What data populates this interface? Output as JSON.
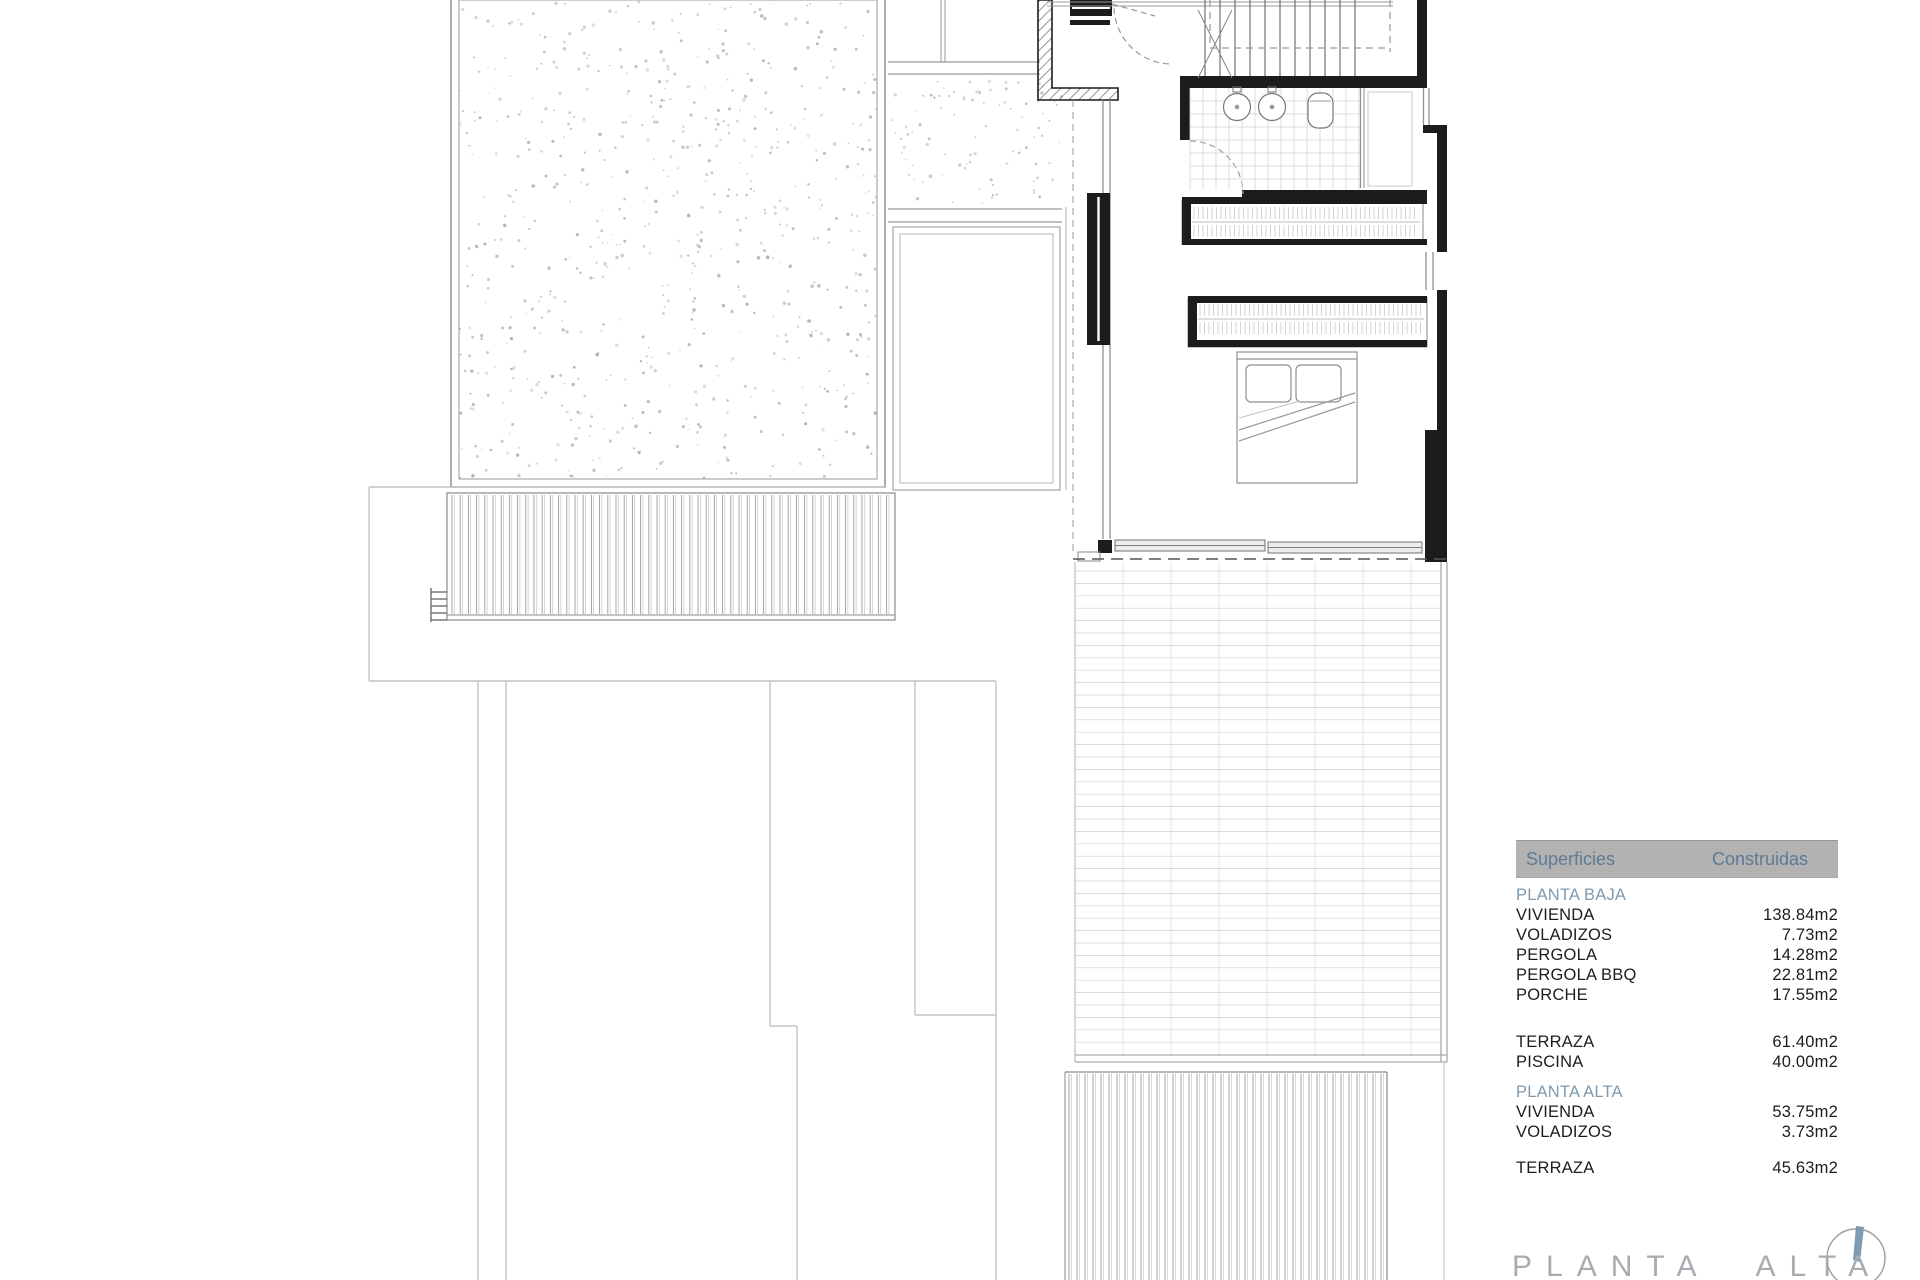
{
  "table": {
    "header": {
      "col1": "Superficies",
      "col2": "Construidas"
    },
    "rows": [
      {
        "label": "PLANTA BAJA",
        "value": "",
        "type": "section"
      },
      {
        "label": "VIVIENDA",
        "value": "138.84m2",
        "type": "item"
      },
      {
        "label": "VOLADIZOS",
        "value": "7.73m2",
        "type": "item"
      },
      {
        "label": "PERGOLA",
        "value": "14.28m2",
        "type": "item"
      },
      {
        "label": "PERGOLA BBQ",
        "value": "22.81m2",
        "type": "item"
      },
      {
        "label": "PORCHE",
        "value": "17.55m2",
        "type": "item"
      },
      {
        "label": "TERRAZA",
        "value": "61.40m2",
        "type": "item"
      },
      {
        "label": "PISCINA",
        "value": "40.00m2",
        "type": "item"
      },
      {
        "label": "PLANTA ALTA",
        "value": "",
        "type": "section"
      },
      {
        "label": "VIVIENDA",
        "value": "53.75m2",
        "type": "item"
      },
      {
        "label": "VOLADIZOS",
        "value": "3.73m2",
        "type": "item"
      },
      {
        "label": "TERRAZA",
        "value": "45.63m2",
        "type": "item"
      }
    ]
  },
  "plan": {
    "title": "PLANTA ALTA",
    "colors": {
      "wall": "#1c1c1c",
      "line": "#8a8a8a",
      "light_line": "#c9c9c9",
      "dashed": "#9a9a9a",
      "title": "#a8acb0",
      "header_bg": "#b2b2b2",
      "header_text": "#5d7a94",
      "section_text": "#7e99ae",
      "needle": "#7e9bb1"
    },
    "compass": {
      "icon": "north-arrow"
    }
  }
}
